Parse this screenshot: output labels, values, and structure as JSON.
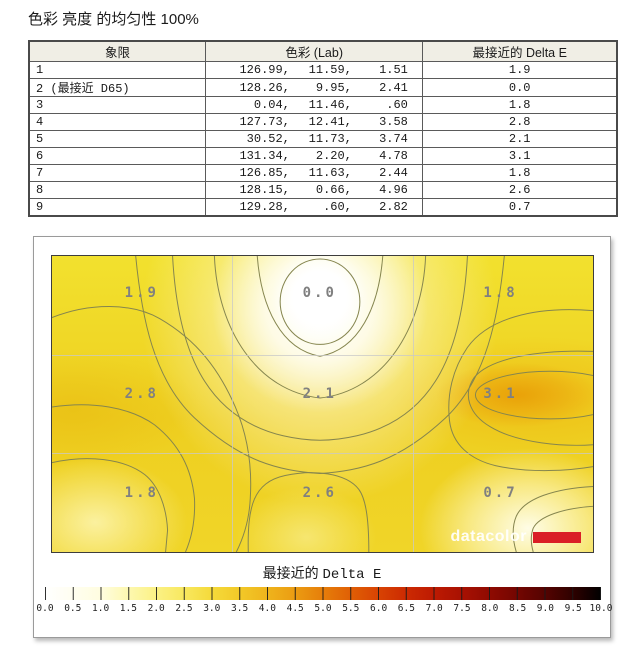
{
  "title": "色彩 亮度 的均匀性 100%",
  "table": {
    "headers": [
      "象限",
      "色彩 (Lab)",
      "最接近的 Delta E"
    ],
    "rows": [
      {
        "quadrant": "1",
        "lab_l": "126.99,",
        "lab_a": "11.59,",
        "lab_b": "1.51",
        "delta_e": "1.9"
      },
      {
        "quadrant": "2 (最接近 D65)",
        "lab_l": "128.26,",
        "lab_a": "9.95,",
        "lab_b": "2.41",
        "delta_e": "0.0"
      },
      {
        "quadrant": "3",
        "lab_l": "0.04,",
        "lab_a": "11.46,",
        "lab_b": ".60",
        "delta_e": "1.8"
      },
      {
        "quadrant": "4",
        "lab_l": "127.73,",
        "lab_a": "12.41,",
        "lab_b": "3.58",
        "delta_e": "2.8"
      },
      {
        "quadrant": "5",
        "lab_l": "30.52,",
        "lab_a": "11.73,",
        "lab_b": "3.74",
        "delta_e": "2.1"
      },
      {
        "quadrant": "6",
        "lab_l": "131.34,",
        "lab_a": "2.20,",
        "lab_b": "4.78",
        "delta_e": "3.1"
      },
      {
        "quadrant": "7",
        "lab_l": "126.85,",
        "lab_a": "11.63,",
        "lab_b": "2.44",
        "delta_e": "1.8"
      },
      {
        "quadrant": "8",
        "lab_l": "128.15,",
        "lab_a": "0.66,",
        "lab_b": "4.96",
        "delta_e": "2.6"
      },
      {
        "quadrant": "9",
        "lab_l": "129.28,",
        "lab_a": ".60,",
        "lab_b": "2.82",
        "delta_e": "0.7"
      }
    ]
  },
  "chart_data": {
    "type": "heatmap",
    "title": "最接近的 Delta E",
    "grid": {
      "rows": 3,
      "cols": 3,
      "grid_lines": true
    },
    "values": [
      [
        1.9,
        0.0,
        1.8
      ],
      [
        2.8,
        2.1,
        3.1
      ],
      [
        1.8,
        2.6,
        0.7
      ]
    ],
    "cell_labels": [
      [
        "1.9",
        "0.0",
        "1.8"
      ],
      [
        "2.8",
        "2.1",
        "3.1"
      ],
      [
        "1.8",
        "2.6",
        "0.7"
      ]
    ],
    "colorbar": {
      "label_cn": "最接近的",
      "label_en": "Delta E",
      "min": 0.0,
      "max": 10.0,
      "step": 0.5,
      "position": "bottom",
      "tick_labels": [
        "0.0",
        "0.5",
        "1.0",
        "1.5",
        "2.0",
        "2.5",
        "3.0",
        "3.5",
        "4.0",
        "4.5",
        "5.0",
        "5.5",
        "6.0",
        "6.5",
        "7.0",
        "7.5",
        "8.0",
        "8.5",
        "9.0",
        "9.5",
        "10.0"
      ],
      "color_low": "#ffffff",
      "color_mid": "#e67e0a",
      "color_high": "#000000"
    },
    "contour_line_color": "#85854e",
    "base_color": "#eed523"
  },
  "map": {
    "watermark": "datacolor",
    "watermark_accent": "#da1f26"
  }
}
